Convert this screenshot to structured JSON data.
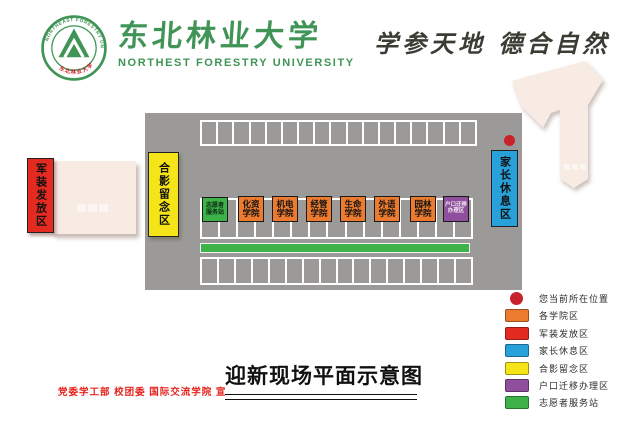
{
  "header": {
    "university_cn": "东北林业大学",
    "university_en": "NORTHEST  FORESTRY  UNIVERSITY",
    "motto": "学参天地 德合自然",
    "logo_ring_text_top": "NORTHEAST FORESTRY UNIVERSITY",
    "logo_ring_text_bottom": "东北林业大学"
  },
  "map": {
    "zones": {
      "photo": "合影留念区",
      "uniform": "军装发放区",
      "parents": "家长休息区"
    },
    "stall_rows": {
      "top": 17,
      "middle": 15,
      "bottom": 16
    },
    "booths": [
      {
        "line1": "志愿者",
        "line2": "服务站",
        "color": "#3cb249"
      },
      {
        "line1": "化资",
        "line2": "学院",
        "color": "#ec7b2f"
      },
      {
        "line1": "机电",
        "line2": "学院",
        "color": "#ec7b2f"
      },
      {
        "line1": "经管",
        "line2": "学院",
        "color": "#ec7b2f"
      },
      {
        "line1": "生命",
        "line2": "学院",
        "color": "#ec7b2f"
      },
      {
        "line1": "外语",
        "line2": "学院",
        "color": "#ec7b2f"
      },
      {
        "line1": "园林",
        "line2": "学院",
        "color": "#ec7b2f"
      },
      {
        "line1": "户口迁移",
        "line2": "办理区",
        "color": "#8f4f9c"
      }
    ]
  },
  "legend": {
    "items": [
      {
        "label": "您当前所在位置",
        "color": "#c8222a",
        "shape": "dot"
      },
      {
        "label": "各学院区",
        "color": "#ec7b2f",
        "shape": "rect"
      },
      {
        "label": "军装发放区",
        "color": "#e42b22",
        "shape": "rect"
      },
      {
        "label": "家长休息区",
        "color": "#28a0d8",
        "shape": "rect"
      },
      {
        "label": "合影留念区",
        "color": "#f5e418",
        "shape": "rect"
      },
      {
        "label": "户口迁移办理区",
        "color": "#8f4f9c",
        "shape": "rect"
      },
      {
        "label": "志愿者服务站",
        "color": "#3cb249",
        "shape": "rect"
      }
    ]
  },
  "footer": {
    "title": "迎新现场平面示意图",
    "credit": "党委学工部  校团委  国际交流学院  宣"
  },
  "colors": {
    "brand_green": "#3f9456",
    "lot_gray": "#9b9a98",
    "cream_building": "#f7ebe4",
    "motto_ink": "#3b3d35",
    "credit_red": "#e5231e"
  }
}
